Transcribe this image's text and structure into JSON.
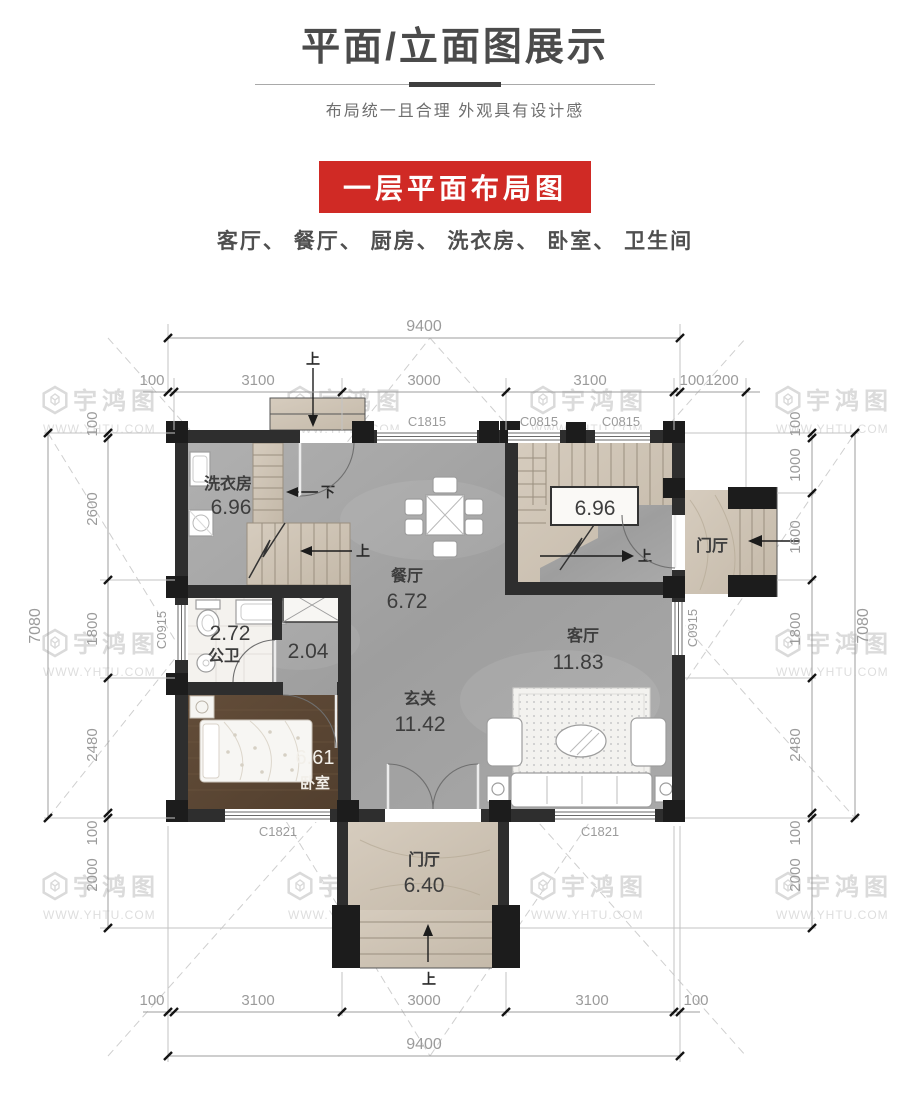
{
  "header": {
    "title": "平面/立面图展示",
    "subtitle": "布局统一且合理 外观具有设计感",
    "banner": "一层平面布局图",
    "room_list": "客厅、 餐厅、 厨房、 洗衣房、 卧室、 卫生间"
  },
  "watermark": {
    "name": "宇鸿图",
    "url": "WWW.YHTU.COM"
  },
  "rooms": {
    "laundry_label": "洗衣房",
    "laundry_area": "6.96",
    "dining_label": "餐厅",
    "dining_area": "6.72",
    "bath_area": "2.72",
    "bath_label": "公卫",
    "hall_area": "2.04",
    "bedroom_area": "6.61",
    "bedroom_label": "卧室",
    "foyer_label": "玄关",
    "foyer_area": "11.42",
    "living_label": "客厅",
    "living_area": "11.83",
    "stair_area": "6.96",
    "front_porch_label": "门厅",
    "front_porch_area": "6.40",
    "side_porch_label": "门厅"
  },
  "windows": {
    "top_1": "C1815",
    "top_2": "C0815",
    "top_3": "C0815",
    "left_1": "C0915",
    "right_1": "C0915",
    "bottom_1": "C1821",
    "bottom_2": "C1821"
  },
  "marks": {
    "up": "上",
    "down": "下"
  },
  "dims": {
    "top_total": "9400",
    "top_a": "100",
    "top_b": "3100",
    "top_c": "3000",
    "top_d": "3100",
    "top_e": "100",
    "top_f": "1200",
    "left_total": "7080",
    "left_a": "100",
    "left_b": "2600",
    "left_c": "1800",
    "left_d": "2480",
    "left_e": "100",
    "left_f": "2000",
    "right_total": "7080",
    "right_a": "100",
    "right_b": "1000",
    "right_c": "1600",
    "right_d": "1800",
    "right_e": "2480",
    "right_f": "100",
    "right_g": "2000",
    "bottom_total": "9400",
    "bottom_a": "100",
    "bottom_b": "3100",
    "bottom_c": "3000",
    "bottom_d": "3100",
    "bottom_e": "100"
  },
  "colors": {
    "banner_red": "#d02a25",
    "wall": "#2e2e2e",
    "pillar": "#1c1c1c",
    "floor_gray": "#a6a6a6",
    "floor_beige": "#cfc5b7",
    "floor_wood": "#5d4836",
    "dim_text": "#9b9b9b"
  }
}
